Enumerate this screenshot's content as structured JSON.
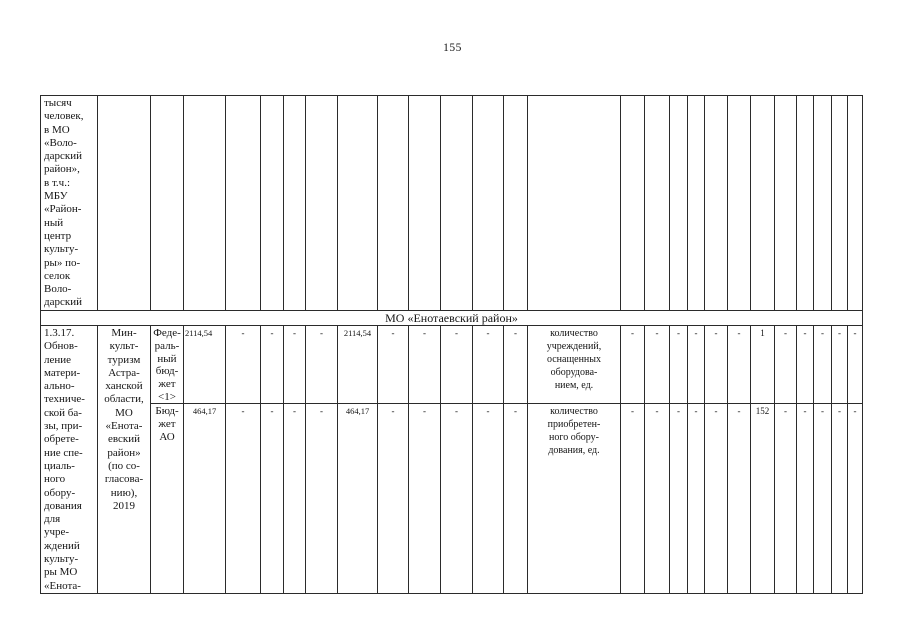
{
  "page": {
    "number": "155"
  },
  "table": {
    "continuation_row": {
      "description": "тысяч\nчеловек,\nв МО\n«Воло-\nдарский\nрайон»,\nв т.ч.:\nМБУ\n«Район-\nный\nцентр\nкульту-\nры» по-\nселок\nВоло-\nдарский"
    },
    "section_header": "МО «Енотаевский район»",
    "task_row": {
      "number_and_title": "1.3.17.\nОбнов-\nление\nматери-\nально-\nтехниче-\nской ба-\nзы, при-\nобрете-\nние спе-\nциаль-\nного\nобору-\nдования\nдля\nучре-\nждений\nкульту-\nры МО\n«Енота-",
      "executor": "Мин-\nкульт-\nтуризм\nАстра-\nханской\nобласти,\nМО\n«Енота-\nевский\nрайон»\n(по со-\nгласова-\nнию),\n2019",
      "budget_rows": [
        {
          "source": "Феде-\nраль-\nный\nбюд-\nжет\n<1>",
          "total": "2114,54",
          "years": [
            "-",
            "-",
            "-",
            "-",
            "2114,54",
            "-",
            "-",
            "-",
            "-",
            "-"
          ]
        },
        {
          "source": "Бюд-\nжет\nАО",
          "total": "464,17",
          "years": [
            "-",
            "-",
            "-",
            "-",
            "464,17",
            "-",
            "-",
            "-",
            "-",
            "-"
          ]
        }
      ],
      "indicator_rows": [
        {
          "name": "количество\nучреждений,\nоснащенных\nоборудова-\nнием, ед.",
          "values": [
            "-",
            "-",
            "-",
            "-",
            "-",
            "-",
            "1",
            "-",
            "-",
            "-",
            "-",
            "-"
          ]
        },
        {
          "name": "количество\nприобретен-\nного обору-\nдования, ед.",
          "values": [
            "-",
            "-",
            "-",
            "-",
            "-",
            "-",
            "152",
            "-",
            "-",
            "-",
            "-",
            "-"
          ]
        }
      ]
    }
  }
}
